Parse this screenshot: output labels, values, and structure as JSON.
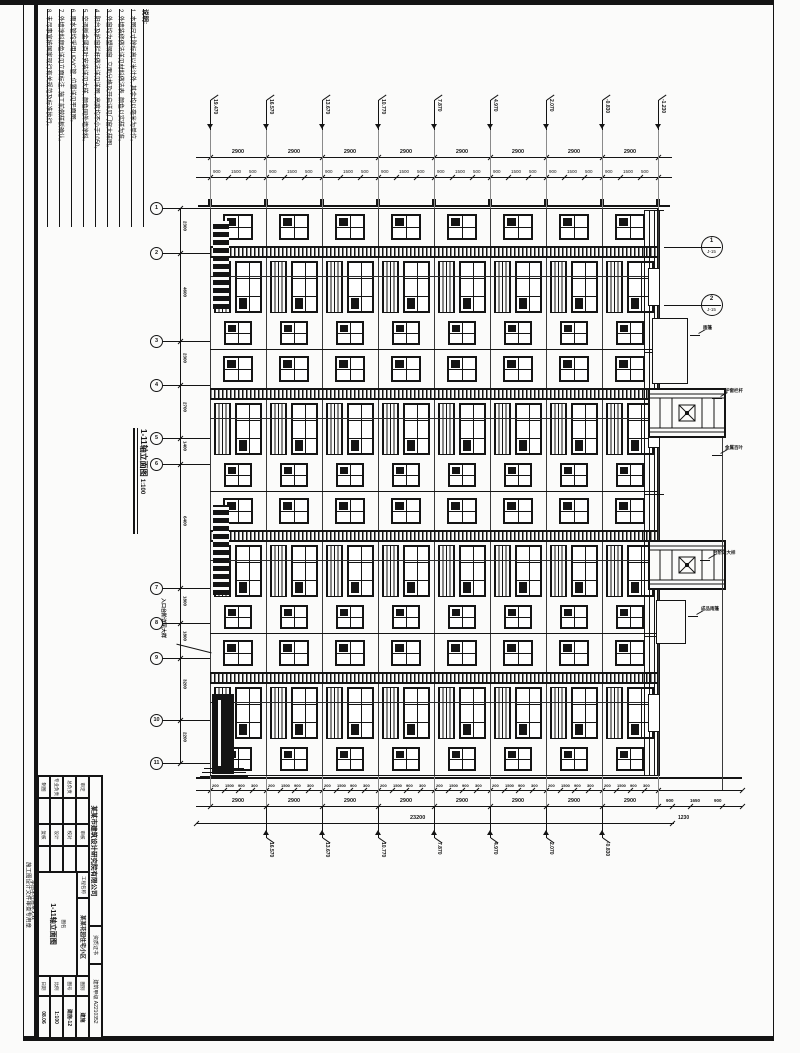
{
  "sheet": {
    "kind": "建筑施工图",
    "orientation": "rotated-90"
  },
  "notes": {
    "title": "说明:",
    "items": [
      "1. 本图尺寸除标高以米计外, 其余均以毫米为单位。",
      "2. 外墙装修做法详见材料做法表, 颜色以实样为准。",
      "3. 外窗均为塑钢窗, 立面分格及开启详见门窗大样图。",
      "4. 阳台及护窗栏杆做法详见详图, 高度均不小于1050。",
      "5. 空调板金属百叶安装详见大样, 颜色同外墙涂料。",
      "6. 雨水管均采用UPVC管, 位置详见平面图。",
      "7. 外墙涂料颜色详见立面标注, 施工前做样板确认。",
      "8. 未尽事宜按国家现行有关规范及标准执行。"
    ]
  },
  "drawing_title": {
    "text": "1-11轴立面图",
    "scale": "1:100"
  },
  "axes": {
    "left": [
      "1",
      "2",
      "3",
      "4",
      "5",
      "6",
      "7",
      "8",
      "9",
      "10",
      "11"
    ]
  },
  "levels": {
    "top": [
      "19.470",
      "16.570",
      "13.670",
      "10.770",
      "7.870",
      "4.970",
      "2.070",
      "-0.830",
      "-1.230"
    ],
    "bottom": [
      "16.570",
      "13.670",
      "10.770",
      "7.870",
      "4.970",
      "2.070",
      "-0.830"
    ]
  },
  "dims": {
    "top_major": [
      "2900",
      "2900",
      "2900",
      "2900",
      "2900",
      "2900",
      "2900",
      "2900"
    ],
    "top_minor": [
      "900",
      "1500",
      "500"
    ],
    "left_axis": [
      "2300",
      "4600",
      "2300",
      "2700",
      "1400",
      "6400",
      "1800",
      "1800",
      "3200",
      "2200"
    ],
    "bottom_minor": [
      "200",
      "1500",
      "900",
      "300"
    ],
    "bottom_major": [
      "2900",
      "2900",
      "2900",
      "2900",
      "2900",
      "2900",
      "2900",
      "2900"
    ],
    "bottom_overall": "23200",
    "bottom_right": [
      "900",
      "1650",
      "900"
    ],
    "right_edge": "1230"
  },
  "details": [
    {
      "num": "1",
      "sheet": "J-15"
    },
    {
      "num": "2",
      "sheet": "J-15"
    }
  ],
  "callouts": {
    "entry": "入口台阶详见大样",
    "canopy": "雨篷",
    "rail": "护窗栏杆",
    "louver": "金属百叶",
    "canopy2": "成品雨篷",
    "step": "台阶详大样"
  },
  "margin_stamp": {
    "line1": "施工图设计文件审查专用章",
    "line2": "本图未经盖章无效"
  },
  "title_block": {
    "company": "某某市建筑设计研究院有限公司",
    "cert_label": "资质证书",
    "cert_no": "建筑甲级 A2210352",
    "project_label": "工程名称",
    "project": "某某花园住宅小区",
    "sign_rows": [
      [
        "审定",
        "",
        "审核",
        ""
      ],
      [
        "总负责",
        "",
        "校对",
        ""
      ],
      [
        "专业负责",
        "",
        "设计",
        ""
      ],
      [
        "制图",
        "",
        "复核",
        ""
      ]
    ],
    "dwg_label": "图名",
    "dwg_name": "1-11轴立面图",
    "meta": [
      [
        "图别",
        "建施"
      ],
      [
        "图号",
        "建施-12"
      ],
      [
        "比例",
        "1:100"
      ],
      [
        "日期",
        "08.06"
      ]
    ]
  }
}
